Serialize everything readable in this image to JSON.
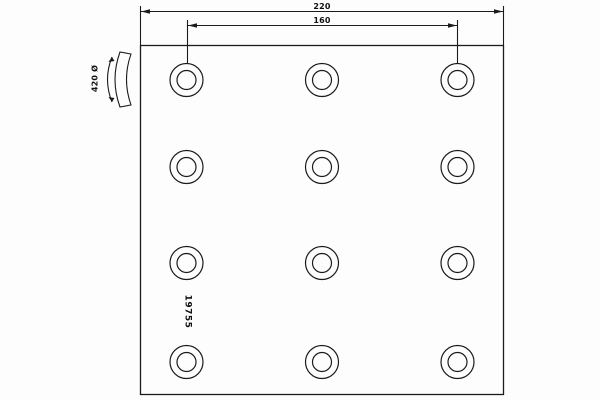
{
  "drawing": {
    "part_number": "19755",
    "dimensions": {
      "overall_width": "220",
      "hole_spacing": "160"
    },
    "curvature_label": "420 Ø",
    "holes": {
      "count": 12,
      "columns_x": [
        186.5,
        322,
        457.5
      ],
      "rows_y": [
        80,
        167,
        263,
        362
      ],
      "outer_radius": 16.5,
      "inner_radius": 9.5
    },
    "colors": {
      "line": "#1b1b1b",
      "text": "#111111",
      "background": "#fdfdfd"
    }
  }
}
